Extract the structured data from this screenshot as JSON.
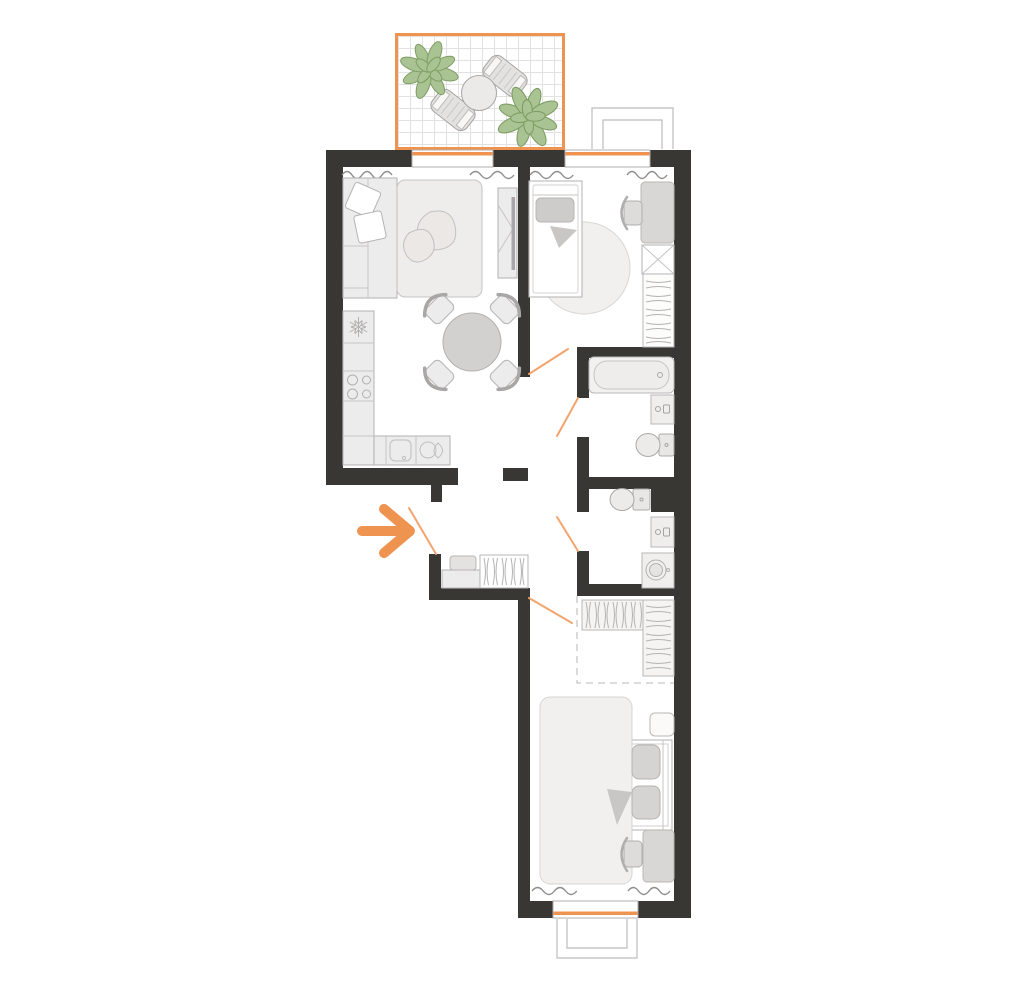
{
  "meta": {
    "kind": "apartment-floor-plan",
    "canvas_w": 1024,
    "canvas_h": 996,
    "text_labels": []
  },
  "colors": {
    "wall": "#393734",
    "accent": "#ef9350",
    "swing": "#f3a46d",
    "plant": "#a9c492",
    "plant_stroke": "#7d9c63",
    "furn_stroke": "#b9b7b7",
    "furn_fill": "#edecec",
    "furn_dark": "#d6d4d3",
    "radiator": "#8f8d8c",
    "grid": "#e2e2e2",
    "dash": "#c8c6c4",
    "sill_box": "#bdbbba"
  },
  "rooms": [
    {
      "id": "balcony",
      "items": [
        "plant",
        "plant",
        "round-table",
        "lounge-chair",
        "lounge-chair"
      ]
    },
    {
      "id": "living-room-kitchen",
      "items": [
        "corner-sofa",
        "pillows",
        "double-bed",
        "tv-console",
        "tv",
        "dining-table",
        "dining-chair-x4",
        "fridge",
        "cabinet",
        "stove",
        "counter",
        "kitchen-sink",
        "faucet-unit"
      ],
      "openings": [
        "balcony-door"
      ]
    },
    {
      "id": "bedroom-small",
      "items": [
        "single-bed",
        "pillow",
        "blanket",
        "round-rug",
        "desk",
        "desk-chair",
        "wardrobe-x",
        "wardrobe-rail"
      ],
      "openings": [
        "window",
        "door"
      ]
    },
    {
      "id": "bathroom",
      "items": [
        "bathtub",
        "washbasin",
        "toilet"
      ],
      "openings": [
        "door"
      ]
    },
    {
      "id": "wc-laundry",
      "items": [
        "toilet",
        "washbasin",
        "washing-machine",
        "duct-shaft"
      ],
      "openings": [
        "door"
      ]
    },
    {
      "id": "hallway-entry",
      "items": [
        "pouf",
        "shoe-bench",
        "coat-rack"
      ],
      "openings": [
        "entrance-door"
      ],
      "marker": "entrance-arrow"
    },
    {
      "id": "bedroom-master",
      "items": [
        "double-bed",
        "duvet",
        "pillow",
        "pillow",
        "blanket-fold",
        "nightstand",
        "walk-in-closet-dashed",
        "wardrobe-rail",
        "wardrobe-shelves",
        "desk",
        "desk-chair"
      ],
      "openings": [
        "window",
        "door"
      ]
    }
  ],
  "door_swings": 5,
  "windows": 3,
  "outside_sill_boxes": 2
}
